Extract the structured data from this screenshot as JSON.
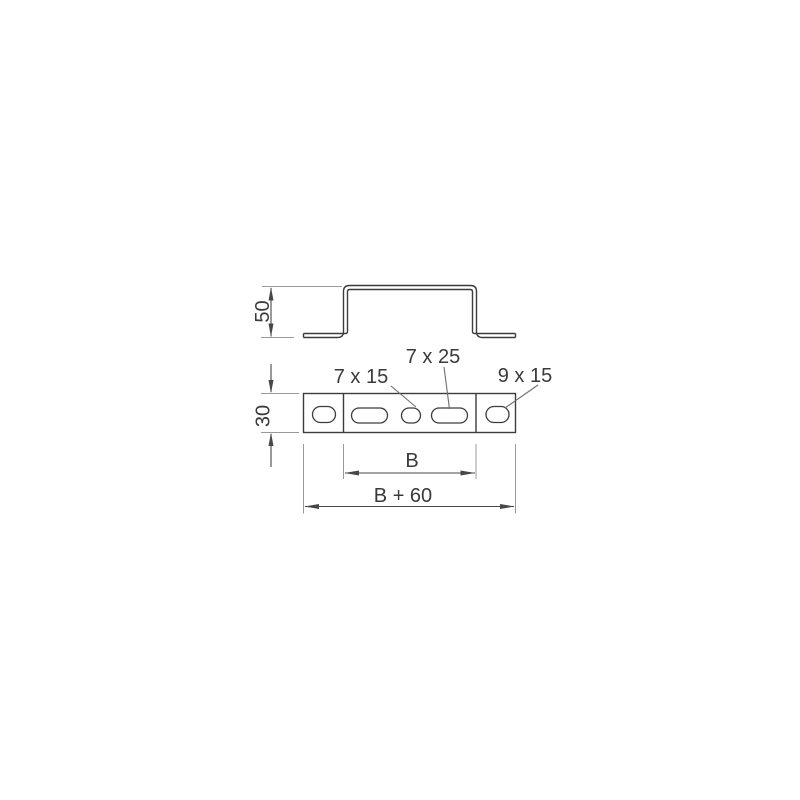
{
  "drawing": {
    "kind": "technical-dimension-drawing",
    "dimensions": {
      "height": "50",
      "flange_width": "30",
      "inner_width": "B",
      "overall_width": "B + 60"
    },
    "hole_labels": {
      "small_slot": "7 x 15",
      "long_slot": "7 x 25",
      "end_oval": "9 x 15"
    },
    "colors": {
      "background": "#ffffff",
      "outline": "#3c3c3c",
      "dimension": "#474747",
      "extension": "#9a9a9a",
      "leader": "#6f6f6f",
      "text": "#3a3a3a"
    }
  }
}
